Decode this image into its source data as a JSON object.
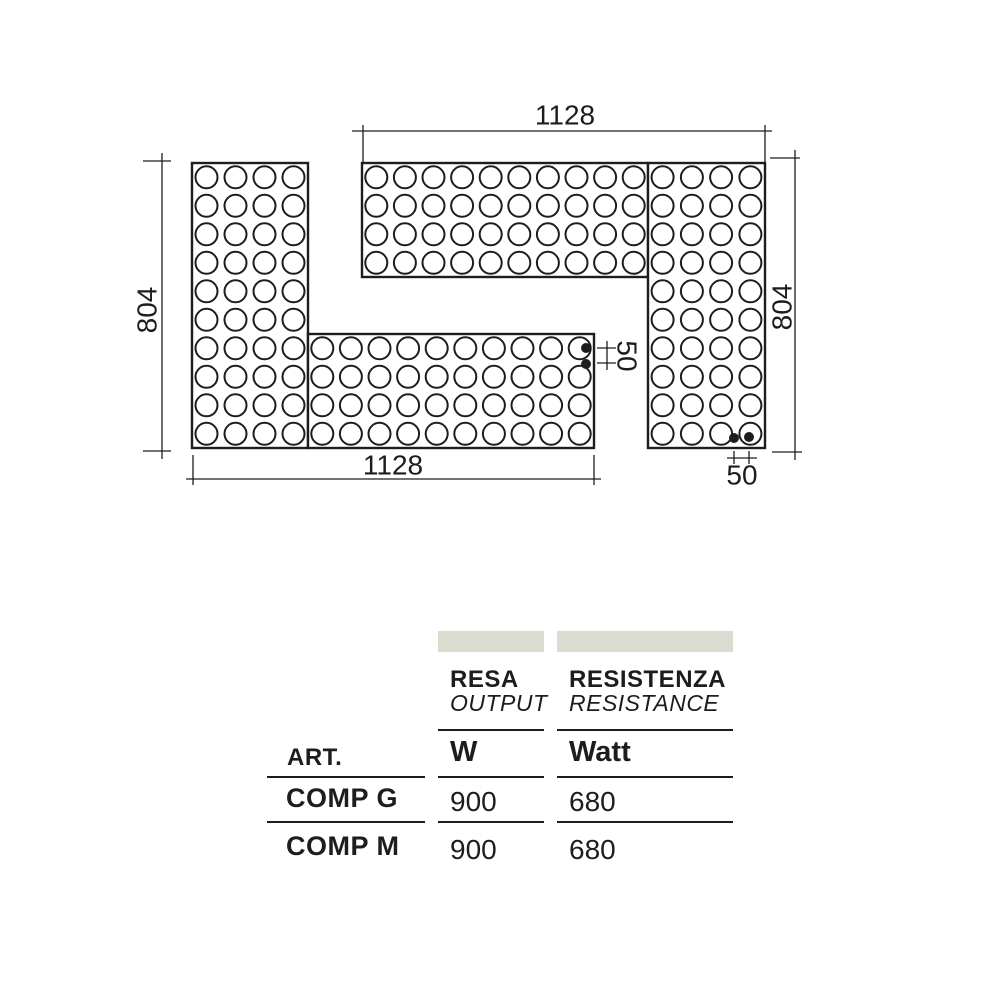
{
  "diagram": {
    "stroke_color": "#1d1d1b",
    "hole_radius": 11,
    "dot_radius": 5,
    "panels": [
      {
        "id": "left-vertical-panel",
        "x": 192,
        "y": 163,
        "w": 116,
        "h": 285,
        "cols": 4,
        "rows": 10
      },
      {
        "id": "left-horizontal-bar",
        "x": 308,
        "y": 334,
        "w": 286,
        "h": 114,
        "cols": 10,
        "rows": 4
      },
      {
        "id": "right-horizontal-bar",
        "x": 362,
        "y": 163,
        "w": 286,
        "h": 114,
        "cols": 10,
        "rows": 4
      },
      {
        "id": "right-vertical-panel",
        "x": 648,
        "y": 163,
        "w": 117,
        "h": 285,
        "cols": 4,
        "rows": 10
      }
    ],
    "connection_dots": [
      {
        "cx": 586,
        "cy": 348
      },
      {
        "cx": 586,
        "cy": 364
      },
      {
        "cx": 734,
        "cy": 438
      },
      {
        "cx": 749,
        "cy": 437
      }
    ],
    "dimension_lines": [
      [
        352,
        131,
        772,
        131
      ],
      [
        363,
        125,
        363,
        162
      ],
      [
        765,
        125,
        765,
        162
      ],
      [
        162,
        153,
        162,
        459
      ],
      [
        143,
        161,
        171,
        161
      ],
      [
        143,
        451,
        171,
        451
      ],
      [
        795,
        150,
        795,
        460
      ],
      [
        770,
        158,
        800,
        158
      ],
      [
        772,
        452,
        802,
        452
      ],
      [
        186,
        479,
        601,
        479
      ],
      [
        193,
        455,
        193,
        485
      ],
      [
        594,
        455,
        594,
        485
      ],
      [
        597,
        348,
        616,
        348
      ],
      [
        597,
        363,
        616,
        363
      ],
      [
        607,
        341,
        607,
        370
      ],
      [
        734,
        451,
        734,
        464
      ],
      [
        749,
        451,
        749,
        464
      ],
      [
        727,
        458,
        757,
        458
      ]
    ],
    "dimension_labels": [
      {
        "text": "1128",
        "x": 565,
        "y": 115,
        "rotate": 0
      },
      {
        "text": "804",
        "x": 147,
        "y": 310,
        "rotate": -90
      },
      {
        "text": "804",
        "x": 782,
        "y": 307,
        "rotate": -90
      },
      {
        "text": "1128",
        "x": 393,
        "y": 465,
        "rotate": 0
      },
      {
        "text": "50",
        "x": 627,
        "y": 356,
        "rotate": 90
      },
      {
        "text": "50",
        "x": 742,
        "y": 475,
        "rotate": 0
      }
    ]
  },
  "table": {
    "accent_bar_color": "#dcdbd0",
    "header_groups": [
      {
        "title": "RESA",
        "subtitle": "OUTPUT"
      },
      {
        "title": "RESISTENZA",
        "subtitle": "RESISTANCE"
      }
    ],
    "columns": [
      {
        "label": "ART."
      },
      {
        "label": "W"
      },
      {
        "label": "Watt"
      }
    ],
    "rows": [
      {
        "art": "COMP G",
        "output_w": "900",
        "resistance_watt": "680"
      },
      {
        "art": "COMP M",
        "output_w": "900",
        "resistance_watt": "680"
      }
    ]
  }
}
